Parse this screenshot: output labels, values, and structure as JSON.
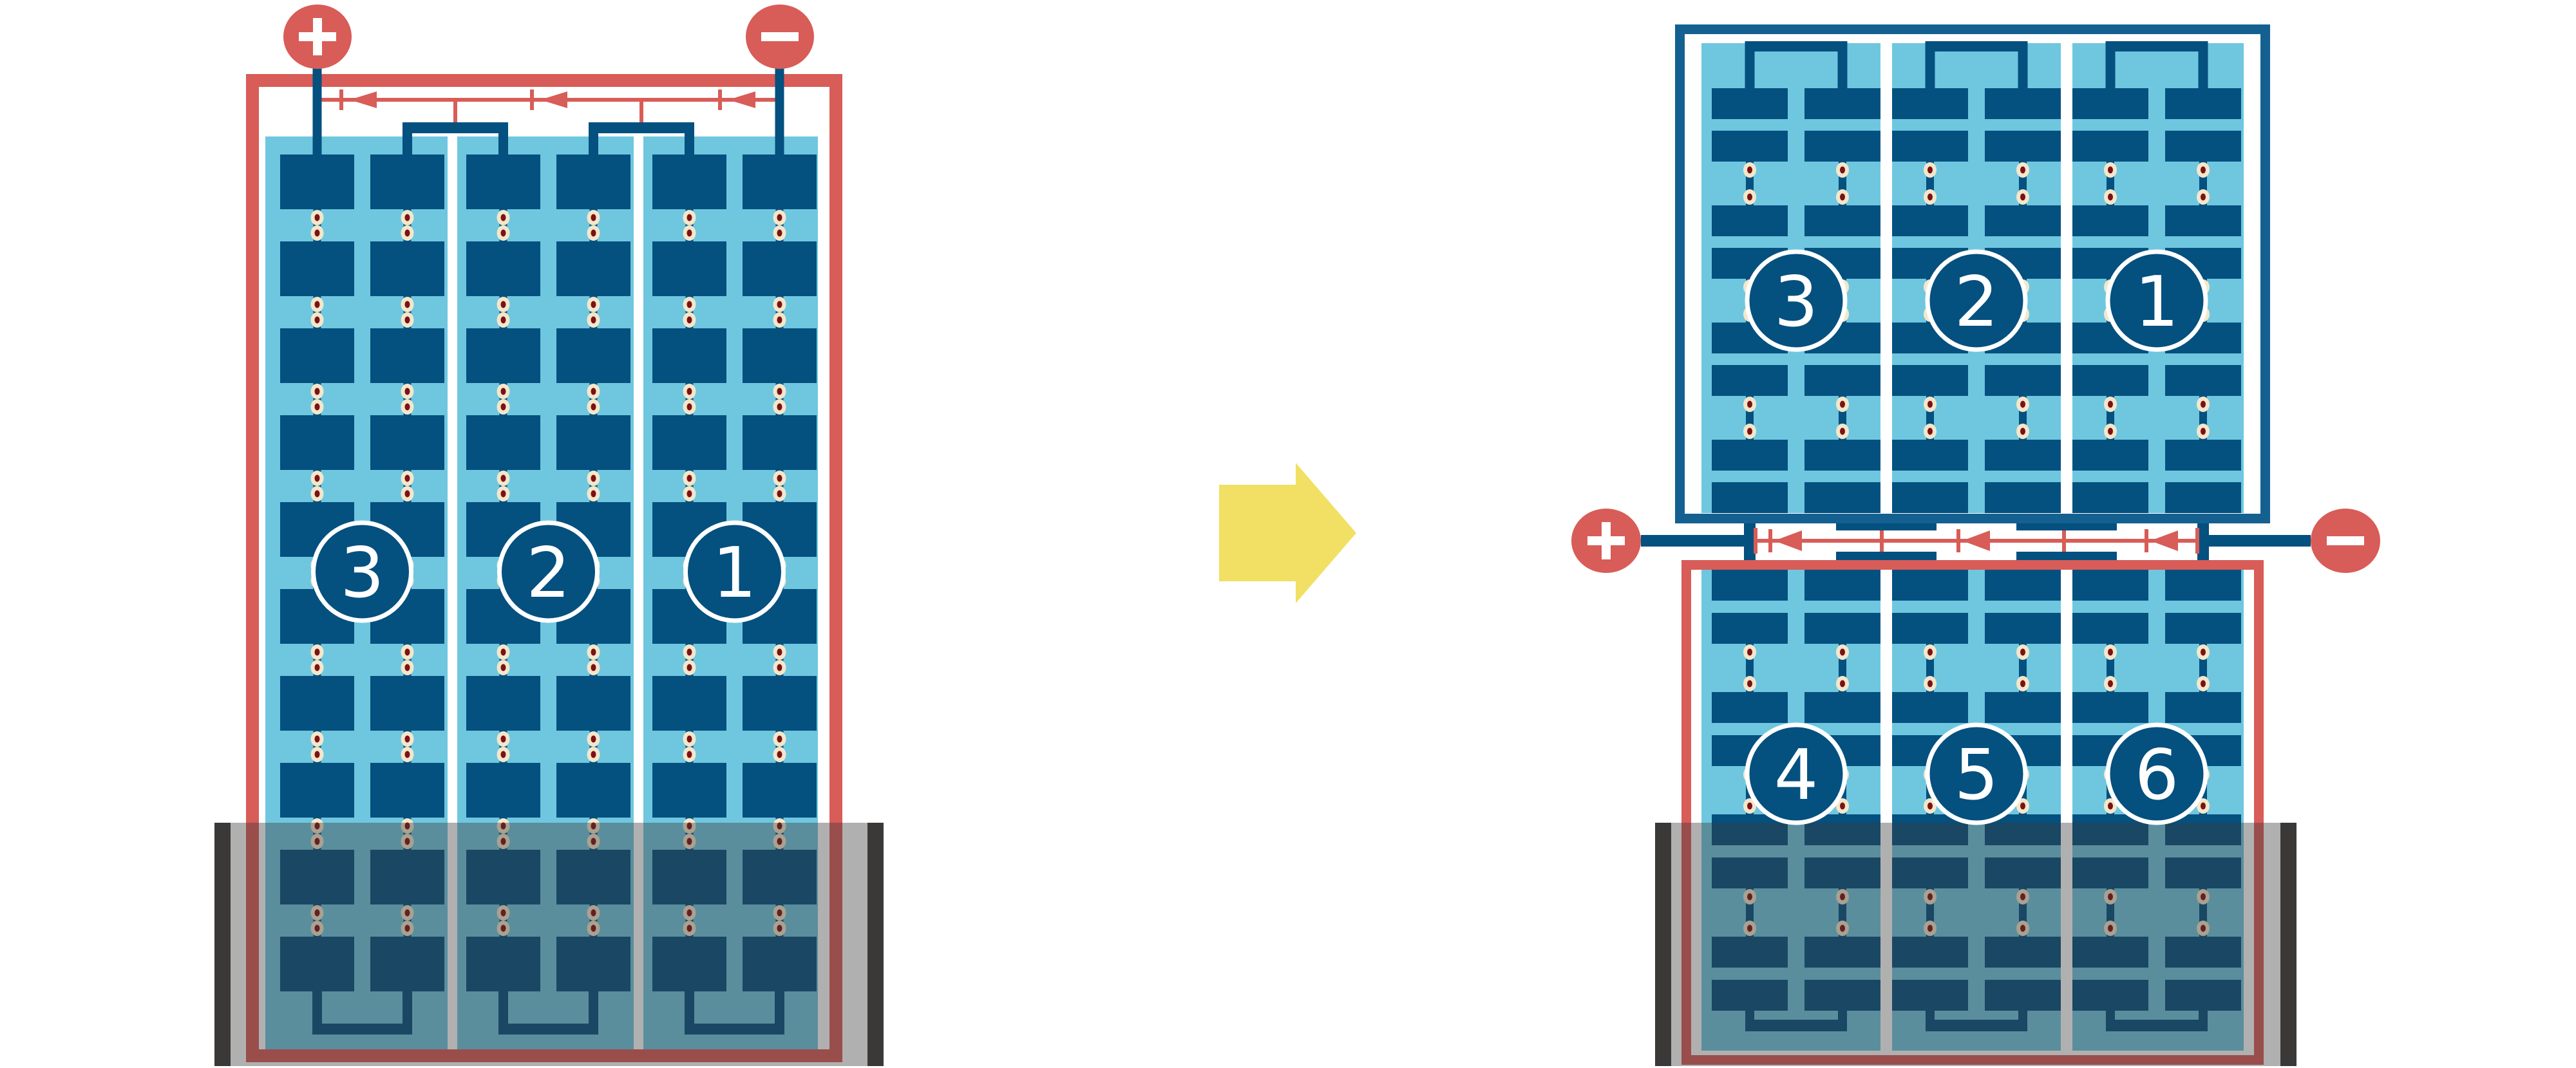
{
  "figure": {
    "background": "#ffffff",
    "colors": {
      "red": "#D85C57",
      "navy": "#04507F",
      "frame_blue": "#136091",
      "sky": "#6FC7DF",
      "white": "#FFFFFF",
      "pad_cream": "#F3E7CB",
      "pad_core": "#7D1113",
      "arrow_yellow": "#F1E063",
      "water_dark_bar": "#3B3938",
      "water_overlay": "rgba(60,58,57,0.40)",
      "badge_stroke": "#FFFFFF"
    },
    "left_module": {
      "description": "portrait full-cell module, lower part flooded",
      "terminals": [
        {
          "sign": "+",
          "polarity": "positive"
        },
        {
          "sign": "−",
          "polarity": "negative"
        }
      ],
      "cell_strings": [
        {
          "label": "3"
        },
        {
          "label": "2"
        },
        {
          "label": "1"
        }
      ],
      "rows_of_cells": 10,
      "columns_per_string": 2,
      "bypass_diodes": 3,
      "flooded_lower_section": true
    },
    "transition_arrow": {
      "direction": "right"
    },
    "right_top_module": {
      "description": "upper half-module above junction",
      "cell_strings": [
        {
          "label": "3"
        },
        {
          "label": "2"
        },
        {
          "label": "1"
        }
      ],
      "rows_of_cells": 8,
      "columns_per_string": 2,
      "flooded_lower_section": false
    },
    "right_junction": {
      "terminals": [
        {
          "sign": "+",
          "polarity": "positive"
        },
        {
          "sign": "−",
          "polarity": "negative"
        }
      ],
      "bypass_diodes": 3
    },
    "right_bottom_module": {
      "description": "lower half-module, lower part flooded",
      "cell_strings": [
        {
          "label": "4"
        },
        {
          "label": "5"
        },
        {
          "label": "6"
        }
      ],
      "rows_of_cells": 8,
      "columns_per_string": 2,
      "flooded_lower_section": true
    }
  }
}
